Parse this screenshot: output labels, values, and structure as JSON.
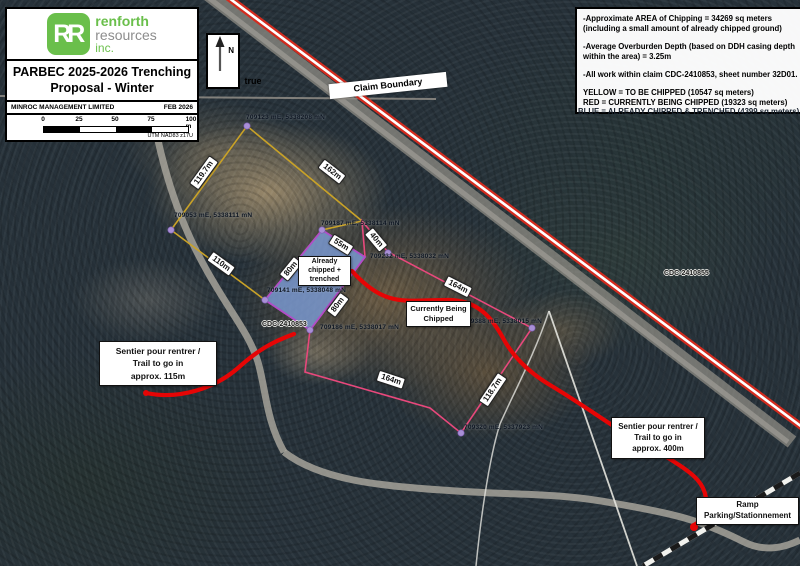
{
  "title_block": {
    "logo_rr": "RR",
    "logo_name_top": "renforth",
    "logo_name_mid": "resources",
    "logo_name_bottom": "inc.",
    "title": "PARBEC 2025-2026 Trenching\nProposal - Winter",
    "company": "MINROC MANAGEMENT LIMITED",
    "date": "FEB 2026",
    "scale_ticks": [
      "0",
      "25",
      "50",
      "75",
      "100 m"
    ],
    "datum": "UTM NAD83 z17U"
  },
  "north_arrow": {
    "n": "N",
    "true_label": "true"
  },
  "info_box": {
    "notes": [
      "-Approximate AREA of Chipping = 34269 sq meters (including a small amount of already chipped ground)",
      "-Average Overburden Depth (based on DDH casing depth within the area) = 3.25m",
      "-All work within claim CDC-2410853, sheet number 32D01."
    ],
    "legend": "YELLOW = TO BE CHIPPED (10547 sq meters)\nRED = CURRENTLY BEING CHIPPED (19323 sq meters)",
    "legend_blue": "BLUE = ALREADY CHIPPED & TRENCHED (4399 sq meters)"
  },
  "map": {
    "claim_boundary_label": "Claim Boundary",
    "claim_west": "CDC-2410853",
    "claim_east": "CDC-2410855",
    "coords": [
      "709123 mE, 5338208 mN",
      "709053 mE, 5338111 mN",
      "709187 mE, 5338114 mN",
      "709232 mE, 5338032 mN",
      "709141 mE, 5338048 mN",
      "709186 mE, 5338017 mN",
      "709388 mE, 5338015 mN",
      "709320 mE, 5337923 mN"
    ],
    "measurements": [
      "119.7m",
      "162m",
      "110m",
      "55m",
      "80m",
      "80m",
      "40m",
      "164m",
      "118.7m",
      "164m"
    ],
    "already_box": "Already\nchipped +\ntrenched",
    "currently_box": "Currently Being\nChipped",
    "trail_left": "Sentier pour rentrer /\nTrail to go in\napprox. 115m",
    "trail_right": "Sentier pour rentrer /\nTrail to go in\napprox. 400m",
    "ramp": "Ramp\nParking/Stationnement",
    "colors": {
      "to_be_chipped": "#c9a227",
      "currently_chipped": "#e8487c",
      "already_chipped": "#7b9bd4",
      "trail": "#e60505",
      "claim_line": "#d42b1e"
    }
  }
}
